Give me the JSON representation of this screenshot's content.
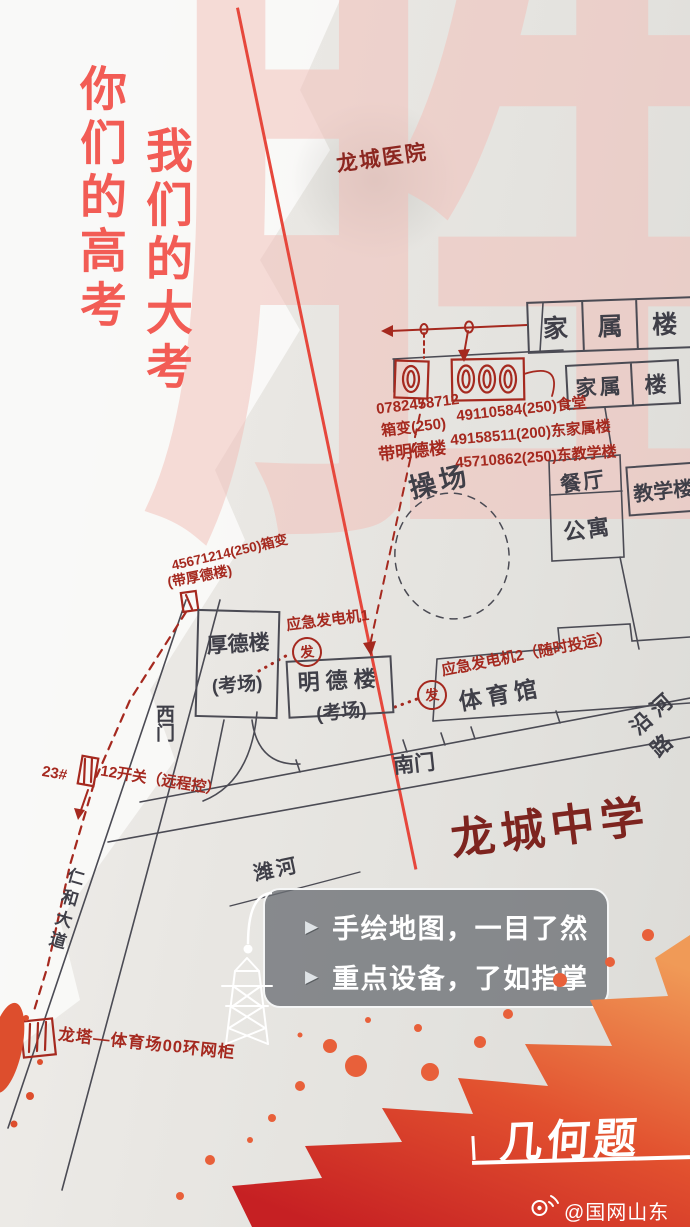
{
  "poster": {
    "slogan_col1": "你们的高考",
    "slogan_col2": "我们的大考",
    "bg_char": "胜",
    "tag": "几何题",
    "credit": "@国网山东电力",
    "colors": {
      "slogan_red": "#f25c55",
      "map_ink": "#4b4b54",
      "annotation_red": "#a5291f",
      "splash_orange": "#f09a57",
      "splash_red": "#c62023"
    }
  },
  "callout": {
    "bullet": "▶",
    "lines": [
      "手绘地图，一目了然",
      "重点设备，了如指掌"
    ]
  },
  "map": {
    "school_name": "龙城中学",
    "hospital": "龙城医院",
    "buildings": {
      "family_row": [
        "家",
        "属",
        "楼"
      ],
      "family2": [
        "家属",
        "楼"
      ],
      "canteen": "餐厅",
      "apartment": "公寓",
      "teaching": "教学楼",
      "playground": "操场",
      "houde": "厚德楼",
      "houde_sub": "(考场)",
      "mingde": "明德楼",
      "mingde_sub": "(考场)",
      "gym": "体育馆"
    },
    "places": {
      "south_gate": "南门",
      "west_gate": "西门",
      "river_road": "沿河路",
      "river": "潍河",
      "avenue": "仁和大道"
    },
    "annotations": {
      "box1_lines": [
        "0782458712",
        "箱变(250)",
        "带明德楼"
      ],
      "box2_lines": [
        "49110584(250)食堂",
        "49158511(200)东家属楼",
        "45710862(250)东教学楼"
      ],
      "left_box_lines": [
        "45671214(250)箱变",
        "(带厚德楼)"
      ],
      "generator1": "应急发电机1",
      "generator2": "应急发电机2（随时投运）",
      "generator_symbol": "发",
      "switch_parts": [
        "23#",
        "12开关（远程控）"
      ],
      "ring_unit": "龙塔—体育场00环网柜"
    }
  }
}
